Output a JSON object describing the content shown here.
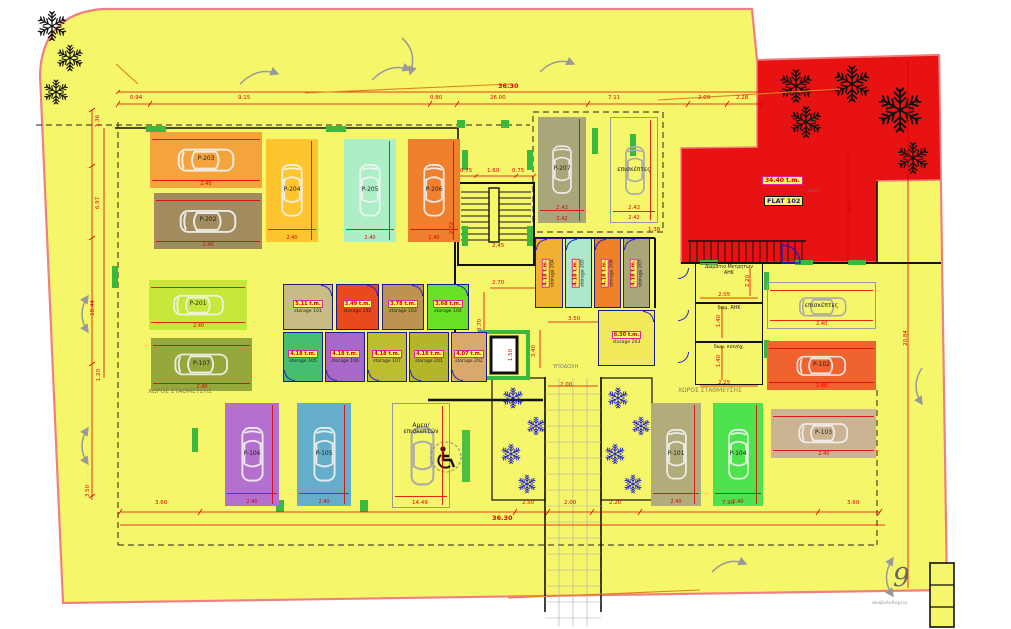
{
  "meta": {
    "sheet_number": "9"
  },
  "colors": {
    "plot_fill": "#f6f66b",
    "courtyard_fill": "#e81212",
    "boundary": "#f08080",
    "dimension_red": "#e00000",
    "storage_wall_blue": "#1b1b8f",
    "door_blue": "#2020c8",
    "column_green": "#3cb83c",
    "tree_black": "#111111",
    "plant_blue": "#1818cc"
  },
  "flat": {
    "name": "FLAT 102",
    "area": "34.40 t.m.",
    "annotation": "αυλή"
  },
  "parking": [
    {
      "id": "P-203",
      "color": "#f5a33c",
      "x": 150,
      "y": 132,
      "w": 112,
      "h": 56,
      "dir": "h",
      "dim": "2.40"
    },
    {
      "id": "P-202",
      "color": "#a38b60",
      "x": 154,
      "y": 193,
      "w": 108,
      "h": 56,
      "dir": "h",
      "dim": "2.40"
    },
    {
      "id": "P-204",
      "color": "#ffc52f",
      "x": 266,
      "y": 139,
      "w": 52,
      "h": 103,
      "dir": "v",
      "dim": "2.40"
    },
    {
      "id": "P-205",
      "color": "#acefc6",
      "x": 344,
      "y": 139,
      "w": 52,
      "h": 103,
      "dir": "v",
      "dim": "2.40"
    },
    {
      "id": "P-206",
      "color": "#f0802e",
      "x": 408,
      "y": 139,
      "w": 52,
      "h": 103,
      "dir": "v",
      "dim": "2.40"
    },
    {
      "id": "P-207",
      "color": "#a9a77a",
      "x": 538,
      "y": 117,
      "w": 48,
      "h": 106,
      "dir": "v",
      "dim": "2.42"
    },
    {
      "id": "επισκέπτες",
      "outline": true,
      "x": 610,
      "y": 117,
      "w": 48,
      "h": 106,
      "dir": "v",
      "dim": "2.42"
    },
    {
      "id": "P-201",
      "color": "#c6e83b",
      "x": 149,
      "y": 280,
      "w": 98,
      "h": 50,
      "dir": "h",
      "dim": "2.40"
    },
    {
      "id": "P-107",
      "color": "#95a83c",
      "x": 151,
      "y": 338,
      "w": 101,
      "h": 53,
      "dir": "h",
      "dim": "2.40"
    },
    {
      "id": "P-106",
      "color": "#b470ce",
      "x": 225,
      "y": 403,
      "w": 54,
      "h": 103,
      "dir": "v",
      "dim": "2.40"
    },
    {
      "id": "P-105",
      "color": "#64aecb",
      "x": 297,
      "y": 403,
      "w": 54,
      "h": 103,
      "dir": "v",
      "dim": "2.40"
    },
    {
      "id": "Αμεα/\nεπισκεπτών",
      "outline": true,
      "wheelchair": true,
      "x": 392,
      "y": 403,
      "w": 58,
      "h": 105,
      "dir": "v"
    },
    {
      "id": "P-101",
      "color": "#b2ac7c",
      "x": 651,
      "y": 403,
      "w": 50,
      "h": 103,
      "dir": "v",
      "dim": "2.40"
    },
    {
      "id": "P-104",
      "color": "#4fe24f",
      "x": 713,
      "y": 403,
      "w": 50,
      "h": 103,
      "dir": "v",
      "dim": "2.40"
    },
    {
      "id": "επισκέπτες",
      "outline": true,
      "x": 767,
      "y": 282,
      "w": 109,
      "h": 47,
      "dir": "h",
      "dim": "2.40"
    },
    {
      "id": "P-102",
      "color": "#f0622e",
      "x": 767,
      "y": 341,
      "w": 109,
      "h": 49,
      "dir": "h",
      "dim": "2.40"
    },
    {
      "id": "P-103",
      "color": "#cbb491",
      "x": 771,
      "y": 409,
      "w": 105,
      "h": 49,
      "dir": "h",
      "dim": "2.40"
    }
  ],
  "storages": [
    {
      "name": "storage 101",
      "area": "5.11 t.m.",
      "color": "#c9bc85",
      "x": 283,
      "y": 284,
      "w": 50,
      "h": 46,
      "door": "tr"
    },
    {
      "name": "storage 102",
      "area": "3.49 t.m.",
      "color": "#e84a1e",
      "x": 336,
      "y": 284,
      "w": 43,
      "h": 46,
      "door": "tr"
    },
    {
      "name": "storage 103",
      "area": "3.78 t.m.",
      "color": "#bd9352",
      "x": 382,
      "y": 284,
      "w": 42,
      "h": 46,
      "door": "tr"
    },
    {
      "name": "storage 104",
      "area": "3.68 t.m.",
      "color": "#69e226",
      "x": 427,
      "y": 284,
      "w": 42,
      "h": 46,
      "door": "tr"
    },
    {
      "name": "storage 105",
      "area": "4.18 t.m.",
      "color": "#46be71",
      "x": 283,
      "y": 332,
      "w": 40,
      "h": 50,
      "door": "bl"
    },
    {
      "name": "storage 106",
      "area": "4.18 t.m.",
      "color": "#a968c9",
      "x": 325,
      "y": 332,
      "w": 40,
      "h": 50,
      "door": "bl"
    },
    {
      "name": "storage 107",
      "area": "4.18 t.m.",
      "color": "#bdbd2e",
      "x": 367,
      "y": 332,
      "w": 40,
      "h": 50,
      "door": "bl"
    },
    {
      "name": "storage 201",
      "area": "4.18 t.m.",
      "color": "#b5b529",
      "x": 409,
      "y": 332,
      "w": 40,
      "h": 50,
      "door": "bl"
    },
    {
      "name": "storage 202",
      "area": "4.07 t.m.",
      "color": "#d9a96b",
      "x": 451,
      "y": 332,
      "w": 36,
      "h": 50,
      "door": "bl"
    },
    {
      "name": "storage 204",
      "area": "4.18 t.m.",
      "color": "#f2b030",
      "x": 535,
      "y": 238,
      "w": 28,
      "h": 70,
      "vert": true,
      "door": "tl"
    },
    {
      "name": "storage 205",
      "area": "4.18 t.m.",
      "color": "#ace8c9",
      "x": 565,
      "y": 238,
      "w": 27,
      "h": 70,
      "vert": true,
      "door": "tl"
    },
    {
      "name": "storage 206",
      "area": "4.18 t.m.",
      "color": "#ef8228",
      "x": 594,
      "y": 238,
      "w": 27,
      "h": 70,
      "vert": true,
      "door": "tl"
    },
    {
      "name": "storage 207",
      "area": "4.18 t.m.",
      "color": "#a9a77a",
      "x": 623,
      "y": 238,
      "w": 27,
      "h": 70,
      "vert": true,
      "door": "tl"
    },
    {
      "name": "storage 203",
      "area": "6.30 t.m.",
      "color": "#f2ea5a",
      "x": 598,
      "y": 310,
      "w": 57,
      "h": 56,
      "door": "tr"
    }
  ],
  "rooms": [
    {
      "name": "Δωμάτιο Μετρητών\nΑΗΚ",
      "x": 695,
      "y": 262,
      "w": 68,
      "h": 41
    },
    {
      "name": "δωμ. ΑΗΚ",
      "x": 695,
      "y": 303,
      "w": 68,
      "h": 39
    },
    {
      "name": "δωμ. κοινόχ.",
      "x": 695,
      "y": 342,
      "w": 68,
      "h": 43
    }
  ],
  "dimensions": [
    {
      "t": "36.30",
      "x": 498,
      "y": 82,
      "big": true
    },
    {
      "t": "0.94",
      "x": 130,
      "y": 95
    },
    {
      "t": "9.15",
      "x": 238,
      "y": 95
    },
    {
      "t": "0.80",
      "x": 430,
      "y": 95
    },
    {
      "t": "26.00",
      "x": 490,
      "y": 95
    },
    {
      "t": "7.11",
      "x": 608,
      "y": 95
    },
    {
      "t": "2.09",
      "x": 698,
      "y": 95
    },
    {
      "t": "2.28",
      "x": 736,
      "y": 95
    },
    {
      "t": "3.60",
      "x": 155,
      "y": 500
    },
    {
      "t": "14.49",
      "x": 412,
      "y": 500
    },
    {
      "t": "2.50",
      "x": 522,
      "y": 500
    },
    {
      "t": "2.00",
      "x": 564,
      "y": 500
    },
    {
      "t": "2.20",
      "x": 609,
      "y": 500
    },
    {
      "t": "7.90",
      "x": 722,
      "y": 500
    },
    {
      "t": "3.60",
      "x": 847,
      "y": 500
    },
    {
      "t": "36.30",
      "x": 492,
      "y": 514,
      "big": true
    },
    {
      "t": "1.36",
      "x": 92,
      "y": 118,
      "rot": true
    },
    {
      "t": "6.97",
      "x": 92,
      "y": 200,
      "rot": true
    },
    {
      "t": "18.44",
      "x": 85,
      "y": 305,
      "rot": true
    },
    {
      "t": "1.20",
      "x": 93,
      "y": 372,
      "rot": true
    },
    {
      "t": "3.50",
      "x": 82,
      "y": 488,
      "rot": true
    },
    {
      "t": "8.59",
      "x": 845,
      "y": 202,
      "rot": true
    },
    {
      "t": "20.84",
      "x": 898,
      "y": 335,
      "rot": true
    },
    {
      "t": "0.75",
      "x": 460,
      "y": 168
    },
    {
      "t": "1.60",
      "x": 487,
      "y": 168
    },
    {
      "t": "0.75",
      "x": 512,
      "y": 168
    },
    {
      "t": "2.42",
      "x": 556,
      "y": 205
    },
    {
      "t": "2.42",
      "x": 628,
      "y": 205
    },
    {
      "t": "1.38",
      "x": 648,
      "y": 227
    },
    {
      "t": "2.72",
      "x": 446,
      "y": 225,
      "rot": true
    },
    {
      "t": "2.45",
      "x": 492,
      "y": 243
    },
    {
      "t": "2.70",
      "x": 492,
      "y": 280
    },
    {
      "t": "3.70",
      "x": 474,
      "y": 322,
      "rot": true
    },
    {
      "t": "3.50",
      "x": 568,
      "y": 316
    },
    {
      "t": "3.40",
      "x": 528,
      "y": 348,
      "rot": true
    },
    {
      "t": "2.00",
      "x": 560,
      "y": 382
    },
    {
      "t": "1.50",
      "x": 505,
      "y": 352,
      "rot": true
    },
    {
      "t": "2.05",
      "x": 718,
      "y": 292
    },
    {
      "t": "2.20",
      "x": 742,
      "y": 278,
      "rot": true
    },
    {
      "t": "1.40",
      "x": 713,
      "y": 318,
      "rot": true
    },
    {
      "t": "1.40",
      "x": 713,
      "y": 358,
      "rot": true
    },
    {
      "t": "2.25",
      "x": 718,
      "y": 380
    }
  ],
  "labels": [
    {
      "name": "zone-parking-left",
      "t": "ΧΩΡΟΣ ΣΤΑΘΜΕΥΣΗΣ",
      "x": 148,
      "y": 388,
      "size": 6,
      "color": "#8b7d55"
    },
    {
      "name": "zone-parking-right",
      "t": "ΧΩΡΟΣ ΣΤΑΘΜΕΥΣΗΣ",
      "x": 678,
      "y": 387,
      "size": 6,
      "color": "#8b7d55"
    },
    {
      "name": "zone-reception",
      "t": "ΥΠΟΔΟΧΗ",
      "x": 553,
      "y": 364,
      "size": 5,
      "color": "#777777"
    },
    {
      "name": "bins-label",
      "t": "σκυβαλοδοχεία",
      "x": 872,
      "y": 601,
      "size": 4.6,
      "color": "#999999"
    },
    {
      "name": "courtyard-label",
      "t": "αυλή",
      "x": 808,
      "y": 188,
      "size": 5,
      "color": "#a05050"
    }
  ]
}
